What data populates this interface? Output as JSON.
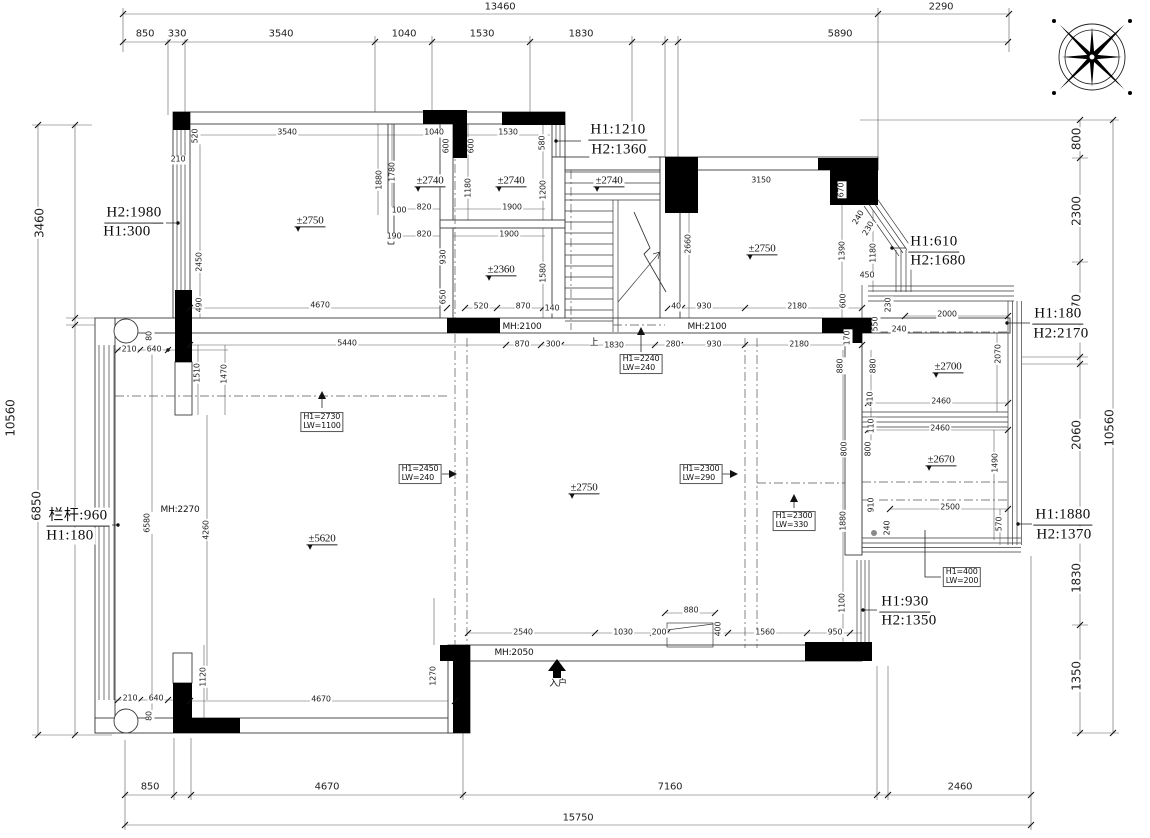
{
  "drawing": {
    "type": "architectural-floor-plan",
    "units": "mm",
    "colors": {
      "line": "#3a3a3a",
      "wall_fill": "#000000",
      "background": "#ffffff",
      "centerline": "#555555"
    },
    "labels": [
      {
        "t": "13460",
        "x": 500,
        "y": 7,
        "s": 10
      },
      {
        "t": "2290",
        "x": 941,
        "y": 7,
        "s": 10
      },
      {
        "t": "850",
        "x": 145,
        "y": 34,
        "s": 10
      },
      {
        "t": "330",
        "x": 177,
        "y": 34,
        "s": 10
      },
      {
        "t": "3540",
        "x": 281,
        "y": 34,
        "s": 10
      },
      {
        "t": "1040",
        "x": 404,
        "y": 34,
        "s": 10
      },
      {
        "t": "1530",
        "x": 482,
        "y": 34,
        "s": 10
      },
      {
        "t": "1830",
        "x": 581,
        "y": 34,
        "s": 10
      },
      {
        "t": "5890",
        "x": 840,
        "y": 34,
        "s": 10
      },
      {
        "t": "3460",
        "x": 40,
        "y": 223,
        "r": -90,
        "s": 12
      },
      {
        "t": "10560",
        "x": 11,
        "y": 418,
        "r": -90,
        "s": 12
      },
      {
        "t": "6850",
        "x": 37,
        "y": 506,
        "r": -90,
        "s": 12
      },
      {
        "t": "800",
        "x": 1077,
        "y": 139,
        "r": -90,
        "s": 12
      },
      {
        "t": "2300",
        "x": 1077,
        "y": 211,
        "r": -90,
        "s": 12
      },
      {
        "t": "2070",
        "x": 1077,
        "y": 309,
        "r": -90,
        "s": 12
      },
      {
        "t": "10560",
        "x": 1110,
        "y": 428,
        "r": -90,
        "s": 12
      },
      {
        "t": "2060",
        "x": 1077,
        "y": 435,
        "r": -90,
        "s": 12
      },
      {
        "t": "1830",
        "x": 1077,
        "y": 578,
        "r": -90,
        "s": 12
      },
      {
        "t": "1350",
        "x": 1077,
        "y": 676,
        "r": -90,
        "s": 12
      },
      {
        "t": "850",
        "x": 150,
        "y": 787,
        "s": 10
      },
      {
        "t": "4670",
        "x": 327,
        "y": 787,
        "s": 10
      },
      {
        "t": "7160",
        "x": 670,
        "y": 787,
        "s": 10
      },
      {
        "t": "2460",
        "x": 960,
        "y": 787,
        "s": 10
      },
      {
        "t": "15750",
        "x": 578,
        "y": 818,
        "s": 10
      },
      {
        "t": "H1:1210",
        "x": 618,
        "y": 131,
        "c": "h",
        "s": 15,
        "u": 1
      },
      {
        "t": "H2:1360",
        "x": 619,
        "y": 150,
        "c": "h",
        "s": 15
      },
      {
        "t": "H2:1980",
        "x": 134,
        "y": 214,
        "c": "h",
        "s": 15,
        "u": 1
      },
      {
        "t": "H1:300",
        "x": 127,
        "y": 232,
        "c": "h",
        "s": 15
      },
      {
        "t": "H1:610",
        "x": 934,
        "y": 243,
        "c": "h",
        "s": 15,
        "u": 1
      },
      {
        "t": "H2:1680",
        "x": 938,
        "y": 261,
        "c": "h",
        "s": 15
      },
      {
        "t": "H1:180",
        "x": 1058,
        "y": 315,
        "c": "h",
        "s": 15,
        "u": 1
      },
      {
        "t": "H2:2170",
        "x": 1061,
        "y": 334,
        "c": "h",
        "s": 15
      },
      {
        "t": "H1:1880",
        "x": 1063,
        "y": 516,
        "c": "h",
        "s": 15,
        "u": 1
      },
      {
        "t": "H2:1370",
        "x": 1064,
        "y": 535,
        "c": "h",
        "s": 15
      },
      {
        "t": "H1:930",
        "x": 905,
        "y": 603,
        "c": "h",
        "s": 15,
        "u": 1
      },
      {
        "t": "H2:1350",
        "x": 909,
        "y": 621,
        "c": "h",
        "s": 15
      },
      {
        "t": "栏杆:960",
        "x": 78,
        "y": 517,
        "c": "h",
        "s": 15,
        "u": 1
      },
      {
        "t": "H1:180",
        "x": 70,
        "y": 536,
        "c": "h",
        "s": 15
      },
      {
        "t": "±2750",
        "x": 310,
        "y": 221,
        "c": "lvl",
        "s": 11
      },
      {
        "t": "±2740",
        "x": 430,
        "y": 181,
        "c": "lvl",
        "s": 11
      },
      {
        "t": "±2740",
        "x": 511,
        "y": 181,
        "c": "lvl",
        "s": 11
      },
      {
        "t": "±2740",
        "x": 609,
        "y": 181,
        "c": "lvl",
        "s": 11
      },
      {
        "t": "±2360",
        "x": 501,
        "y": 270,
        "c": "lvl",
        "s": 11
      },
      {
        "t": "±2750",
        "x": 762,
        "y": 249,
        "c": "lvl",
        "s": 11
      },
      {
        "t": "±2700",
        "x": 948,
        "y": 367,
        "c": "lvl",
        "s": 11
      },
      {
        "t": "±2670",
        "x": 941,
        "y": 460,
        "c": "lvl",
        "s": 11
      },
      {
        "t": "±2750",
        "x": 584,
        "y": 488,
        "c": "lvl",
        "s": 11
      },
      {
        "t": "±5620",
        "x": 322,
        "y": 539,
        "c": "lvl",
        "s": 11
      },
      {
        "t": "MH:2100",
        "x": 522,
        "y": 327,
        "c": "mh",
        "s": 9
      },
      {
        "t": "MH:2100",
        "x": 707,
        "y": 327,
        "c": "mh",
        "s": 9
      },
      {
        "t": "MH:2270",
        "x": 180,
        "y": 510,
        "c": "mh",
        "s": 9
      },
      {
        "t": "MH:2050",
        "x": 514,
        "y": 653,
        "c": "mh",
        "s": 9
      },
      {
        "t": "入户",
        "x": 558,
        "y": 684,
        "c": "cn",
        "s": 9
      },
      {
        "t": "上",
        "x": 594,
        "y": 343,
        "c": "cn",
        "s": 9
      },
      {
        "t": "H1=2730\nLW=1100",
        "x": 322,
        "y": 422,
        "c": "box",
        "s": 8
      },
      {
        "t": "H1=2450\nLW=240",
        "x": 420,
        "y": 474,
        "c": "box",
        "s": 8
      },
      {
        "t": "H1=2240\nLW=240",
        "x": 641,
        "y": 364,
        "c": "box",
        "s": 8
      },
      {
        "t": "H1=2300\nLW=290",
        "x": 701,
        "y": 474,
        "c": "box",
        "s": 8
      },
      {
        "t": "H1=2300\nLW=330",
        "x": 794,
        "y": 521,
        "c": "box",
        "s": 8
      },
      {
        "t": "H1=400\nLW=200",
        "x": 962,
        "y": 577,
        "c": "box",
        "s": 8
      },
      {
        "t": "520",
        "x": 196,
        "y": 136,
        "r": -90
      },
      {
        "t": "210",
        "x": 178,
        "y": 160
      },
      {
        "t": "3540",
        "x": 287,
        "y": 133
      },
      {
        "t": "2450",
        "x": 200,
        "y": 262,
        "r": -90
      },
      {
        "t": "490",
        "x": 200,
        "y": 305,
        "r": -90
      },
      {
        "t": "4670",
        "x": 320,
        "y": 306
      },
      {
        "t": "1880",
        "x": 380,
        "y": 180,
        "r": -90
      },
      {
        "t": "1780",
        "x": 393,
        "y": 172,
        "r": -90
      },
      {
        "t": "1040",
        "x": 434,
        "y": 133
      },
      {
        "t": "600",
        "x": 447,
        "y": 146,
        "r": -90
      },
      {
        "t": "600",
        "x": 472,
        "y": 146,
        "r": -90
      },
      {
        "t": "100",
        "x": 399,
        "y": 211
      },
      {
        "t": "820",
        "x": 424,
        "y": 208
      },
      {
        "t": "190",
        "x": 394,
        "y": 237
      },
      {
        "t": "820",
        "x": 424,
        "y": 235
      },
      {
        "t": "930",
        "x": 444,
        "y": 257,
        "r": -90
      },
      {
        "t": "650",
        "x": 444,
        "y": 297,
        "r": -90
      },
      {
        "t": "1530",
        "x": 508,
        "y": 133
      },
      {
        "t": "580",
        "x": 543,
        "y": 143,
        "r": -90
      },
      {
        "t": "1180",
        "x": 469,
        "y": 188,
        "r": -90
      },
      {
        "t": "1200",
        "x": 544,
        "y": 190,
        "r": -90
      },
      {
        "t": "1900",
        "x": 512,
        "y": 208
      },
      {
        "t": "1900",
        "x": 509,
        "y": 235
      },
      {
        "t": "1580",
        "x": 544,
        "y": 273,
        "r": -90
      },
      {
        "t": "520",
        "x": 481,
        "y": 307
      },
      {
        "t": "870",
        "x": 523,
        "y": 307
      },
      {
        "t": "140",
        "x": 552,
        "y": 309
      },
      {
        "t": "2660",
        "x": 689,
        "y": 244,
        "r": -90
      },
      {
        "t": "3150",
        "x": 761,
        "y": 181
      },
      {
        "t": "670",
        "x": 842,
        "y": 190,
        "r": -90
      },
      {
        "t": "1390",
        "x": 843,
        "y": 251,
        "r": -90
      },
      {
        "t": "1180",
        "x": 874,
        "y": 253,
        "r": -90
      },
      {
        "t": "450",
        "x": 867,
        "y": 276
      },
      {
        "t": "600",
        "x": 844,
        "y": 301,
        "r": -90
      },
      {
        "t": "240",
        "x": 859,
        "y": 218,
        "r": -60
      },
      {
        "t": "230",
        "x": 869,
        "y": 229,
        "r": -60
      },
      {
        "t": "40",
        "x": 676,
        "y": 307
      },
      {
        "t": "930",
        "x": 704,
        "y": 307
      },
      {
        "t": "2180",
        "x": 797,
        "y": 307
      },
      {
        "t": "5440",
        "x": 347,
        "y": 344
      },
      {
        "t": "870",
        "x": 522,
        "y": 345
      },
      {
        "t": "300",
        "x": 553,
        "y": 345
      },
      {
        "t": "1830",
        "x": 614,
        "y": 346
      },
      {
        "t": "280",
        "x": 673,
        "y": 345
      },
      {
        "t": "930",
        "x": 714,
        "y": 345
      },
      {
        "t": "2180",
        "x": 799,
        "y": 345
      },
      {
        "t": "550",
        "x": 876,
        "y": 324,
        "r": -90
      },
      {
        "t": "230",
        "x": 889,
        "y": 305,
        "r": -90
      },
      {
        "t": "240",
        "x": 899,
        "y": 330
      },
      {
        "t": "2000",
        "x": 947,
        "y": 315
      },
      {
        "t": "170",
        "x": 848,
        "y": 338,
        "r": -90
      },
      {
        "t": "210",
        "x": 129,
        "y": 350
      },
      {
        "t": "640",
        "x": 154,
        "y": 350
      },
      {
        "t": "80",
        "x": 150,
        "y": 336,
        "r": -90
      },
      {
        "t": "1510",
        "x": 198,
        "y": 373,
        "r": -90
      },
      {
        "t": "1470",
        "x": 225,
        "y": 374,
        "r": -90
      },
      {
        "t": "6580",
        "x": 148,
        "y": 523,
        "r": -90
      },
      {
        "t": "4260",
        "x": 207,
        "y": 530,
        "r": -90
      },
      {
        "t": "2070",
        "x": 999,
        "y": 354,
        "r": -90
      },
      {
        "t": "2460",
        "x": 941,
        "y": 402
      },
      {
        "t": "2460",
        "x": 940,
        "y": 429
      },
      {
        "t": "880",
        "x": 841,
        "y": 366,
        "r": -90
      },
      {
        "t": "880",
        "x": 874,
        "y": 366,
        "r": -90
      },
      {
        "t": "410",
        "x": 871,
        "y": 399,
        "r": -90
      },
      {
        "t": "110",
        "x": 872,
        "y": 426,
        "r": -90
      },
      {
        "t": "800",
        "x": 845,
        "y": 449,
        "r": -90
      },
      {
        "t": "800",
        "x": 869,
        "y": 449,
        "r": -90
      },
      {
        "t": "1490",
        "x": 996,
        "y": 463,
        "r": -90
      },
      {
        "t": "910",
        "x": 872,
        "y": 505,
        "r": -90
      },
      {
        "t": "2500",
        "x": 950,
        "y": 508
      },
      {
        "t": "570",
        "x": 1000,
        "y": 524,
        "r": -90
      },
      {
        "t": "240",
        "x": 888,
        "y": 528,
        "r": -90
      },
      {
        "t": "1880",
        "x": 844,
        "y": 521,
        "r": -90
      },
      {
        "t": "1100",
        "x": 843,
        "y": 603,
        "r": -90
      },
      {
        "t": "2540",
        "x": 523,
        "y": 633
      },
      {
        "t": "1030",
        "x": 623,
        "y": 633
      },
      {
        "t": "200",
        "x": 659,
        "y": 633
      },
      {
        "t": "880",
        "x": 691,
        "y": 611
      },
      {
        "t": "400",
        "x": 719,
        "y": 629,
        "r": -90
      },
      {
        "t": "1560",
        "x": 765,
        "y": 633
      },
      {
        "t": "950",
        "x": 835,
        "y": 633
      },
      {
        "t": "1120",
        "x": 204,
        "y": 677,
        "r": -90
      },
      {
        "t": "1270",
        "x": 434,
        "y": 676,
        "r": -90
      },
      {
        "t": "4670",
        "x": 321,
        "y": 700
      },
      {
        "t": "210",
        "x": 130,
        "y": 699
      },
      {
        "t": "640",
        "x": 156,
        "y": 699
      },
      {
        "t": "80",
        "x": 150,
        "y": 716,
        "r": -90
      }
    ]
  }
}
